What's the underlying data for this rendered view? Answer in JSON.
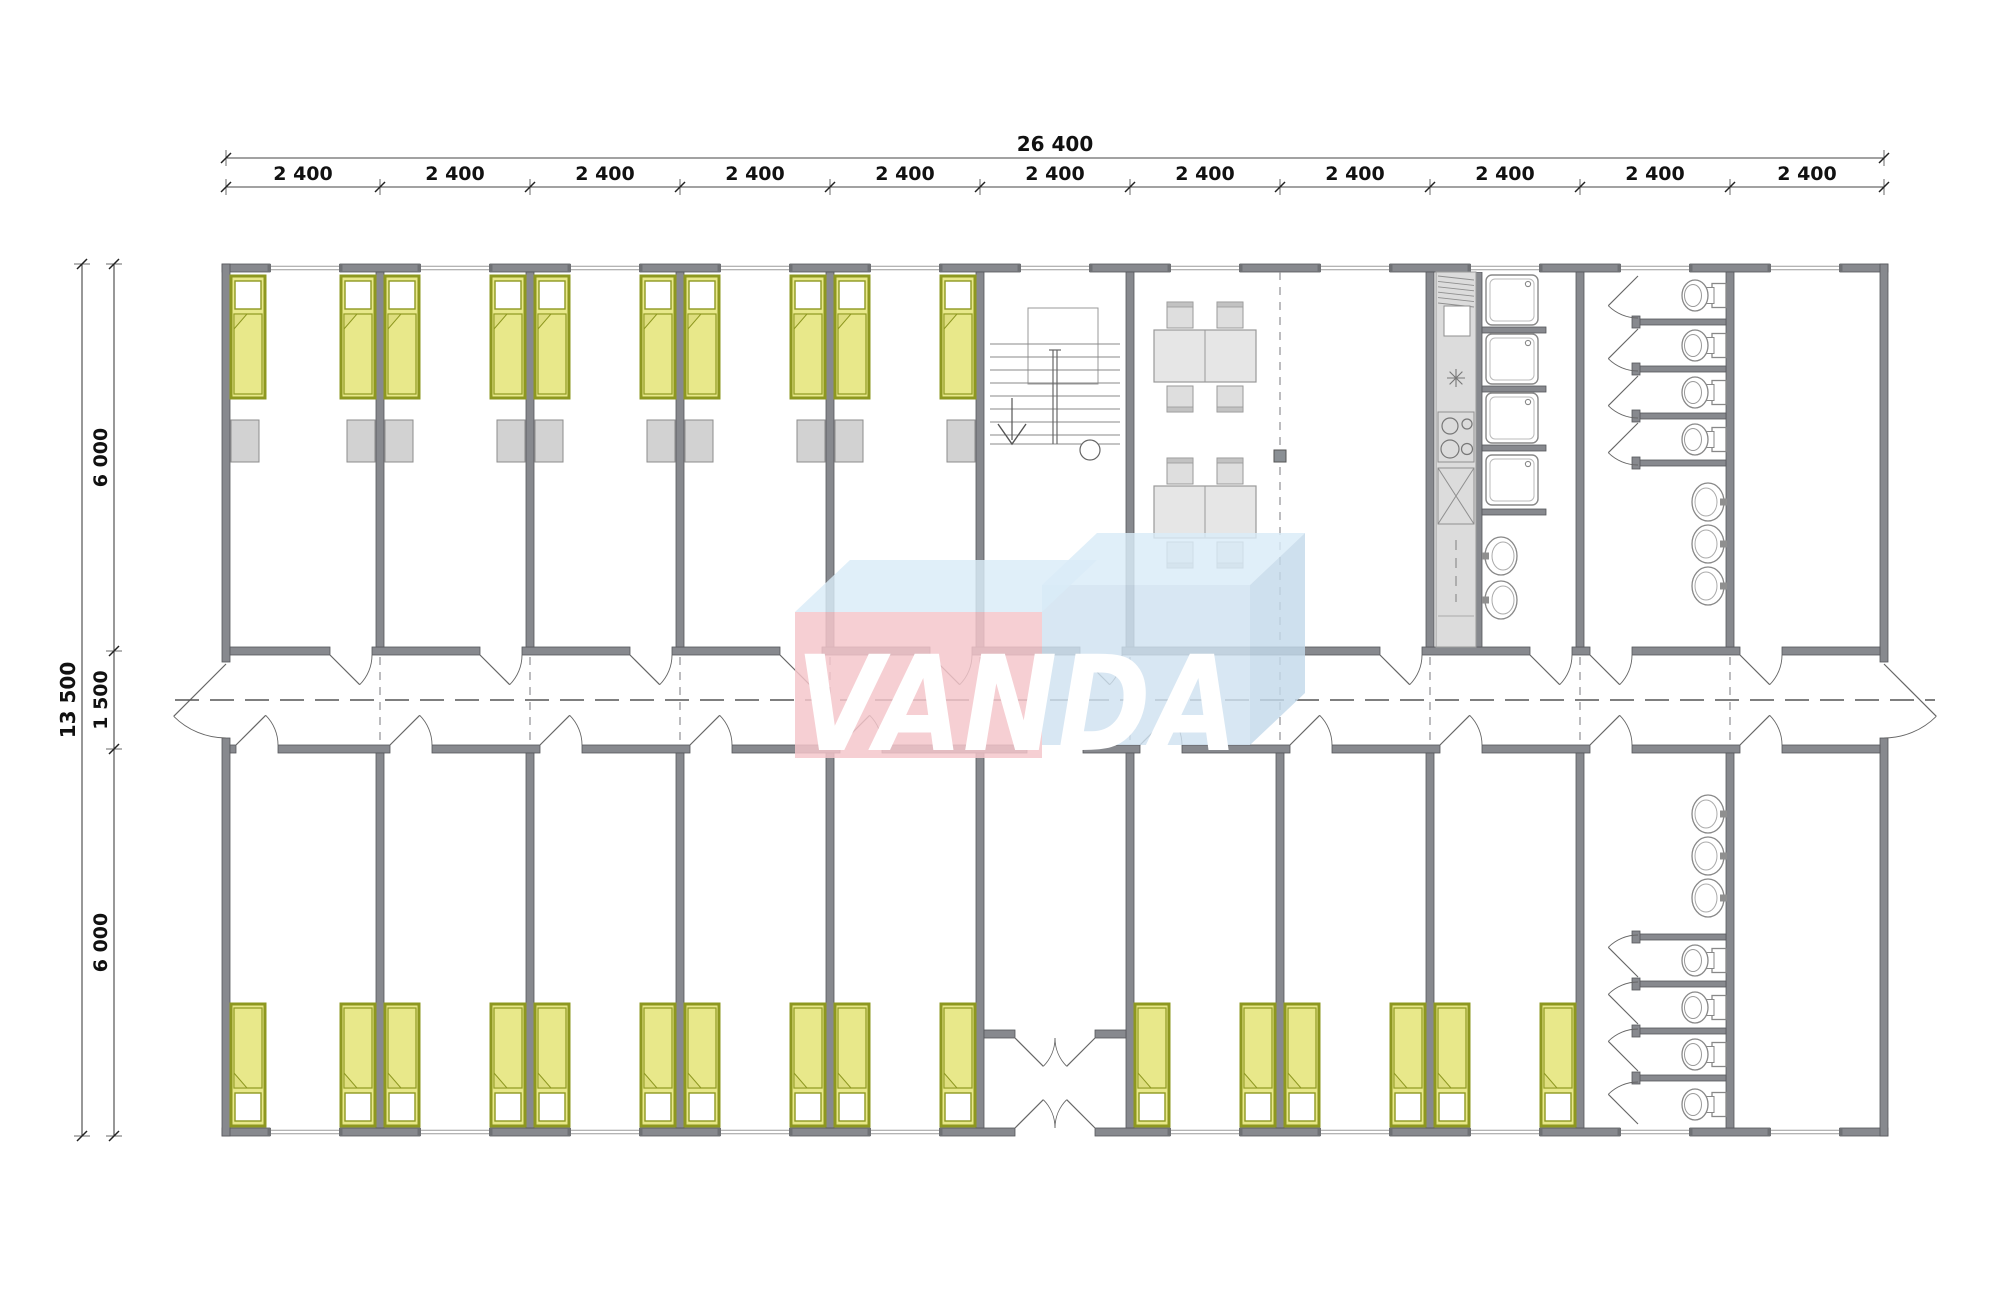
{
  "title": "Modular dormitory building floor plan",
  "watermark": {
    "text": "VANDA",
    "pink_face": "#f4c6cb",
    "blue_face": "#cfe2f0",
    "blue_side": "#c3d9ea",
    "top_face": "#d9ecf8",
    "text_color": "#ffffff"
  },
  "dimensions": {
    "total_width_label": "26 400",
    "module_width_labels": [
      "2 400",
      "2 400",
      "2 400",
      "2 400",
      "2 400",
      "2 400",
      "2 400",
      "2 400",
      "2 400",
      "2 400",
      "2 400"
    ],
    "total_height_label": "13 500",
    "height_segment_labels": [
      "6 000",
      "1 500",
      "6 000"
    ]
  },
  "palette": {
    "wall": "#87898e",
    "wall_edge": "#55575b",
    "bed_fill": "#e8e88a",
    "bed_fold": "#dede7e",
    "bed_border": "#8e9820",
    "furniture": "#dedede",
    "furniture_edge": "#999999",
    "locker": "#d2d2d2",
    "locker_edge": "#8c8c8c",
    "counter": "#dcdcdc",
    "line": "#777777",
    "joint": "#8f9094",
    "centerline": "#555555",
    "column": "#8a8f94",
    "dim_text": "#111111",
    "dim_line": "#444444"
  },
  "modules": {
    "top": [
      "bedroom",
      "bedroom",
      "bedroom",
      "bedroom",
      "bedroom",
      "stairwell",
      "dining",
      "dining",
      "kitchen",
      "toilets",
      "empty"
    ],
    "bottom": [
      "bedroom",
      "bedroom",
      "bedroom",
      "bedroom",
      "bedroom",
      "vestibule",
      "bedroom",
      "bedroom",
      "bedroom",
      "toilets",
      "empty"
    ]
  },
  "fixture_counts": {
    "beds": 26,
    "bedside_lockers": 10,
    "dining_tables": 2,
    "chairs_per_table": 4,
    "shower_trays": 4,
    "toilet_stalls": 8,
    "washbasins": 8,
    "staircases": 1
  }
}
